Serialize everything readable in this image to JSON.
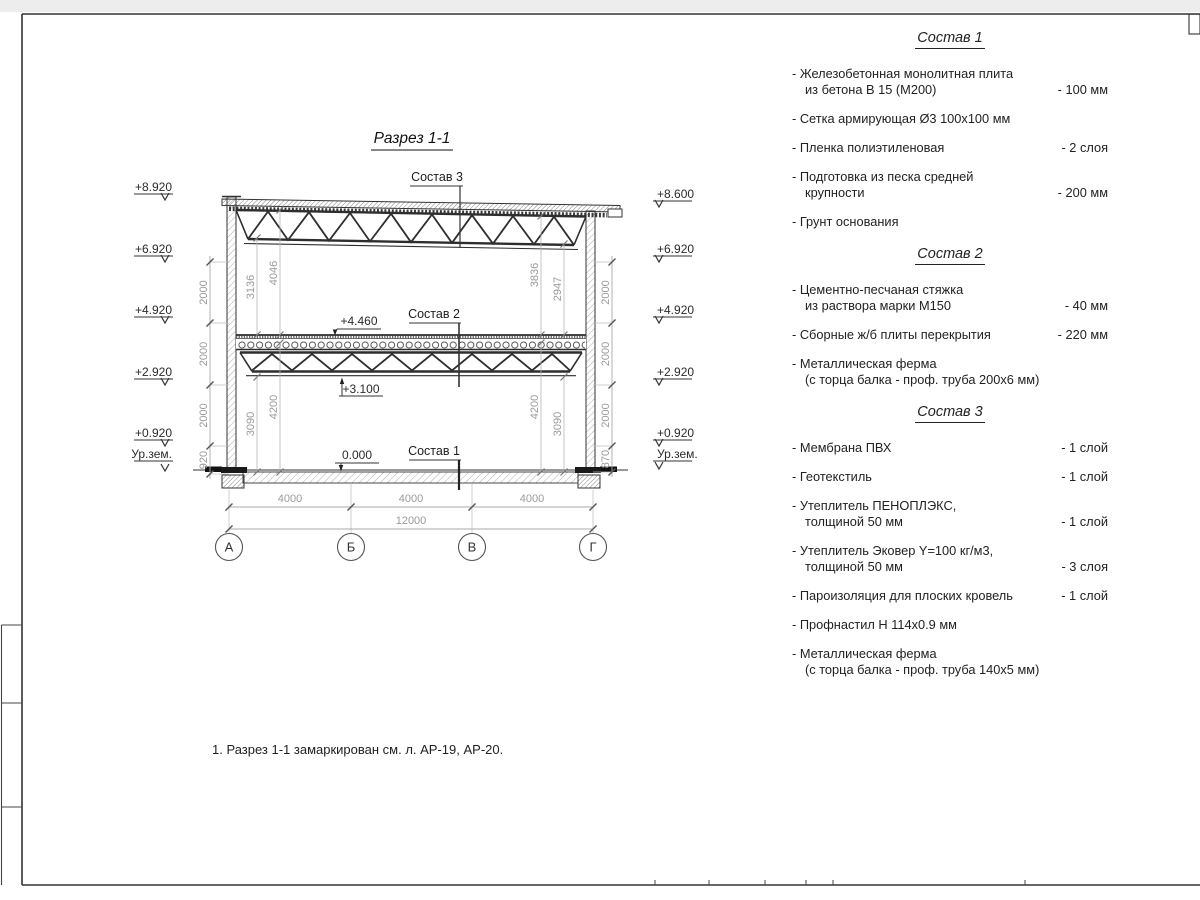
{
  "sheet": {
    "title": "Разрез 1-1",
    "note": "1. Разрез 1-1 замаркирован см. л. АР-19, АР-20."
  },
  "section": {
    "callouts": {
      "sostav3": "Состав 3",
      "sostav2": "Состав 2",
      "sostav1": "Состав 1"
    },
    "inline_elevations": {
      "mid_top": "+4.460",
      "mid_bottom": "+3.100",
      "floor": "0.000"
    },
    "elevations_left": [
      "+8.920",
      "+6.920",
      "+4.920",
      "+2.920",
      "+0.920",
      "Ур.зем."
    ],
    "elevations_right": [
      "+8.600",
      "+6.920",
      "+4.920",
      "+2.920",
      "+0.920",
      "Ур.зем."
    ],
    "chain_left": [
      "2000",
      "2000",
      "2000",
      "920"
    ],
    "chain_right": [
      "2000",
      "2000",
      "2000",
      "870"
    ],
    "dims_inner_left": [
      "3136",
      "4046",
      "3090",
      "4200"
    ],
    "dims_inner_right": [
      "3836",
      "2947",
      "4200",
      "3090"
    ],
    "dims_bottom": [
      "4000",
      "4000",
      "4000"
    ],
    "dim_total": "12000",
    "axes": [
      "А",
      "Б",
      "В",
      "Г"
    ]
  },
  "compositions": [
    {
      "title": "Состав 1",
      "items": [
        {
          "text": "- Железобетонная  монолитная плита\nиз бетона В 15 (М200)",
          "value": "- 100 мм"
        },
        {
          "text": "- Сетка армирующая Ø3 100x100 мм",
          "value": ""
        },
        {
          "text": "- Пленка полиэтиленовая",
          "value": "-  2 слоя"
        },
        {
          "text": "- Подготовка из песка средней\nкрупности",
          "value": "- 200 мм"
        },
        {
          "text": "- Грунт основания",
          "value": ""
        }
      ]
    },
    {
      "title": "Состав 2",
      "items": [
        {
          "text": "- Цементно-песчаная стяжка\nиз раствора марки М150",
          "value": "- 40 мм"
        },
        {
          "text": "- Сборные ж/б плиты перекрытия",
          "value": "- 220 мм"
        },
        {
          "text": "- Металлическая ферма\n(с торца балка - проф. труба 200x6 мм)",
          "value": ""
        }
      ]
    },
    {
      "title": "Состав 3",
      "items": [
        {
          "text": "- Мембрана ПВХ",
          "value": "- 1 слой"
        },
        {
          "text": "- Геотекстиль",
          "value": "- 1 слой"
        },
        {
          "text": "- Утеплитель ПЕНОПЛЭКС,\nтолщиной 50 мм",
          "value": "- 1 слой"
        },
        {
          "text": "- Утеплитель Эковер Y=100 кг/м3,\nтолщиной 50 мм",
          "value": "- 3 слоя"
        },
        {
          "text": "- Пароизоляция для плоских кровель",
          "value": "- 1 слой"
        },
        {
          "text": "- Профнастил Н 114x0.9 мм",
          "value": ""
        },
        {
          "text": "- Металлическая ферма\n(с торца балка - проф. труба 140x5 мм)",
          "value": ""
        }
      ]
    }
  ]
}
